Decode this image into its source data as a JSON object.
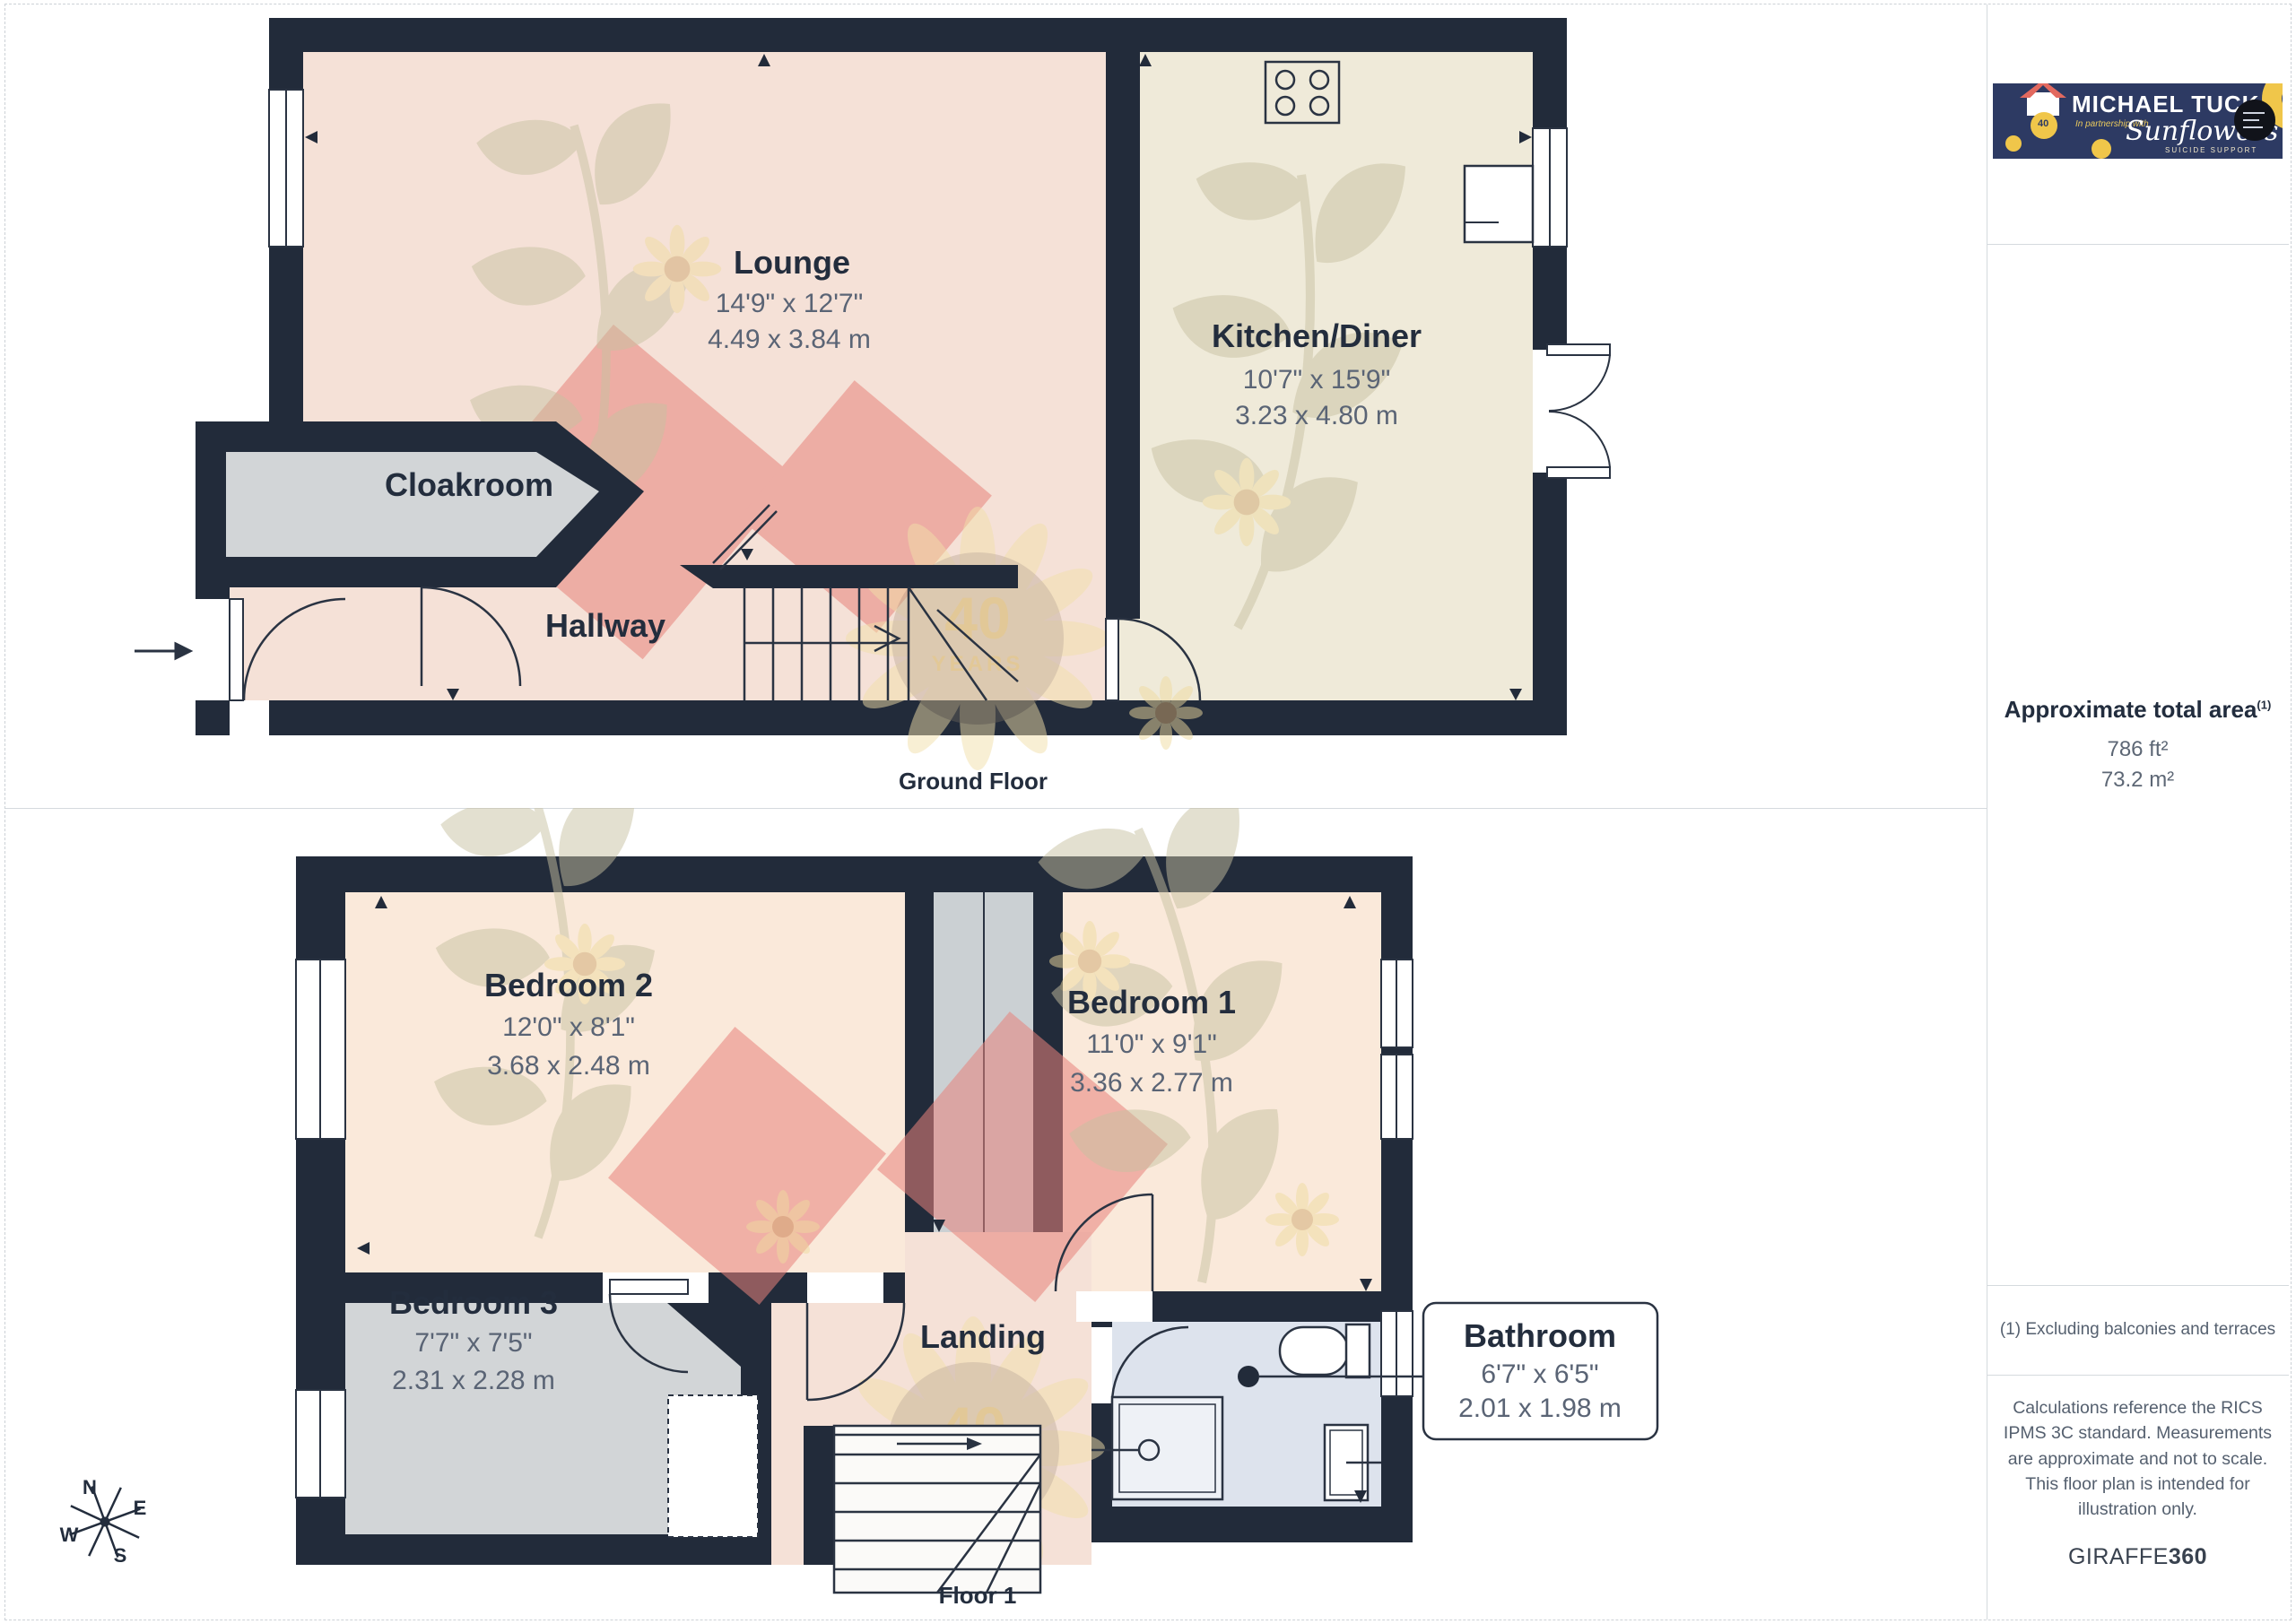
{
  "ground_floor": {
    "label": "Ground Floor",
    "lounge": {
      "name": "Lounge",
      "imperial": "14'9\" x 12'7\"",
      "metric": "4.49 x 3.84 m"
    },
    "kitchen": {
      "name": "Kitchen/Diner",
      "imperial": "10'7\" x 15'9\"",
      "metric": "3.23 x 4.80 m"
    },
    "cloakroom": {
      "name": "Cloakroom"
    },
    "hallway": {
      "name": "Hallway"
    }
  },
  "floor_1": {
    "label": "Floor 1",
    "bedroom2": {
      "name": "Bedroom 2",
      "imperial": "12'0\" x 8'1\"",
      "metric": "3.68 x 2.48 m"
    },
    "bedroom1": {
      "name": "Bedroom 1",
      "imperial": "11'0\" x 9'1\"",
      "metric": "3.36 x 2.77 m"
    },
    "bedroom3": {
      "name": "Bedroom 3",
      "imperial": "7'7\" x 7'5\"",
      "metric": "2.31 x 2.28 m"
    },
    "landing": {
      "name": "Landing"
    },
    "bathroom": {
      "name": "Bathroom",
      "imperial": "6'7\" x 6'5\"",
      "metric": "2.01 x 1.98 m"
    }
  },
  "sidebar": {
    "logo": {
      "title": "MICHAEL TUCK",
      "partnership": "In partnership with",
      "partner": "Sunflowers",
      "partner_sub": "SUICIDE SUPPORT",
      "badge_years": "40"
    },
    "area": {
      "title": "Approximate total area",
      "footnote_marker": "(1)",
      "imperial": "786 ft²",
      "metric": "73.2 m²"
    },
    "footnote": "(1) Excluding balconies and terraces",
    "disclaimer": "Calculations reference the RICS IPMS 3C standard. Measurements are approximate and not to scale. This floor plan is intended for illustration only.",
    "brand": {
      "name": "GIRAFFE",
      "suffix": "360"
    }
  },
  "compass": {
    "n": "N",
    "e": "E",
    "s": "S",
    "w": "W"
  },
  "watermark": {
    "line1": "40",
    "line2": "YEARS"
  },
  "colors": {
    "wall": "#222b3a",
    "lounge_floor": "#f5e1d7",
    "kitchen_floor": "#efead9",
    "bedroom_floor": "#fae9da",
    "grey_floor": "#d2d5d7",
    "bathroom_floor": "#dde3ed",
    "rug_red": "#e8837c",
    "watermark_olive": "#c6c1a0",
    "watermark_yellow": "#eeda9e",
    "text_navy": "#232d3d",
    "text_grey": "#5a6475",
    "logo_navy": "#2d3a63",
    "logo_yellow": "#f0c64a"
  }
}
